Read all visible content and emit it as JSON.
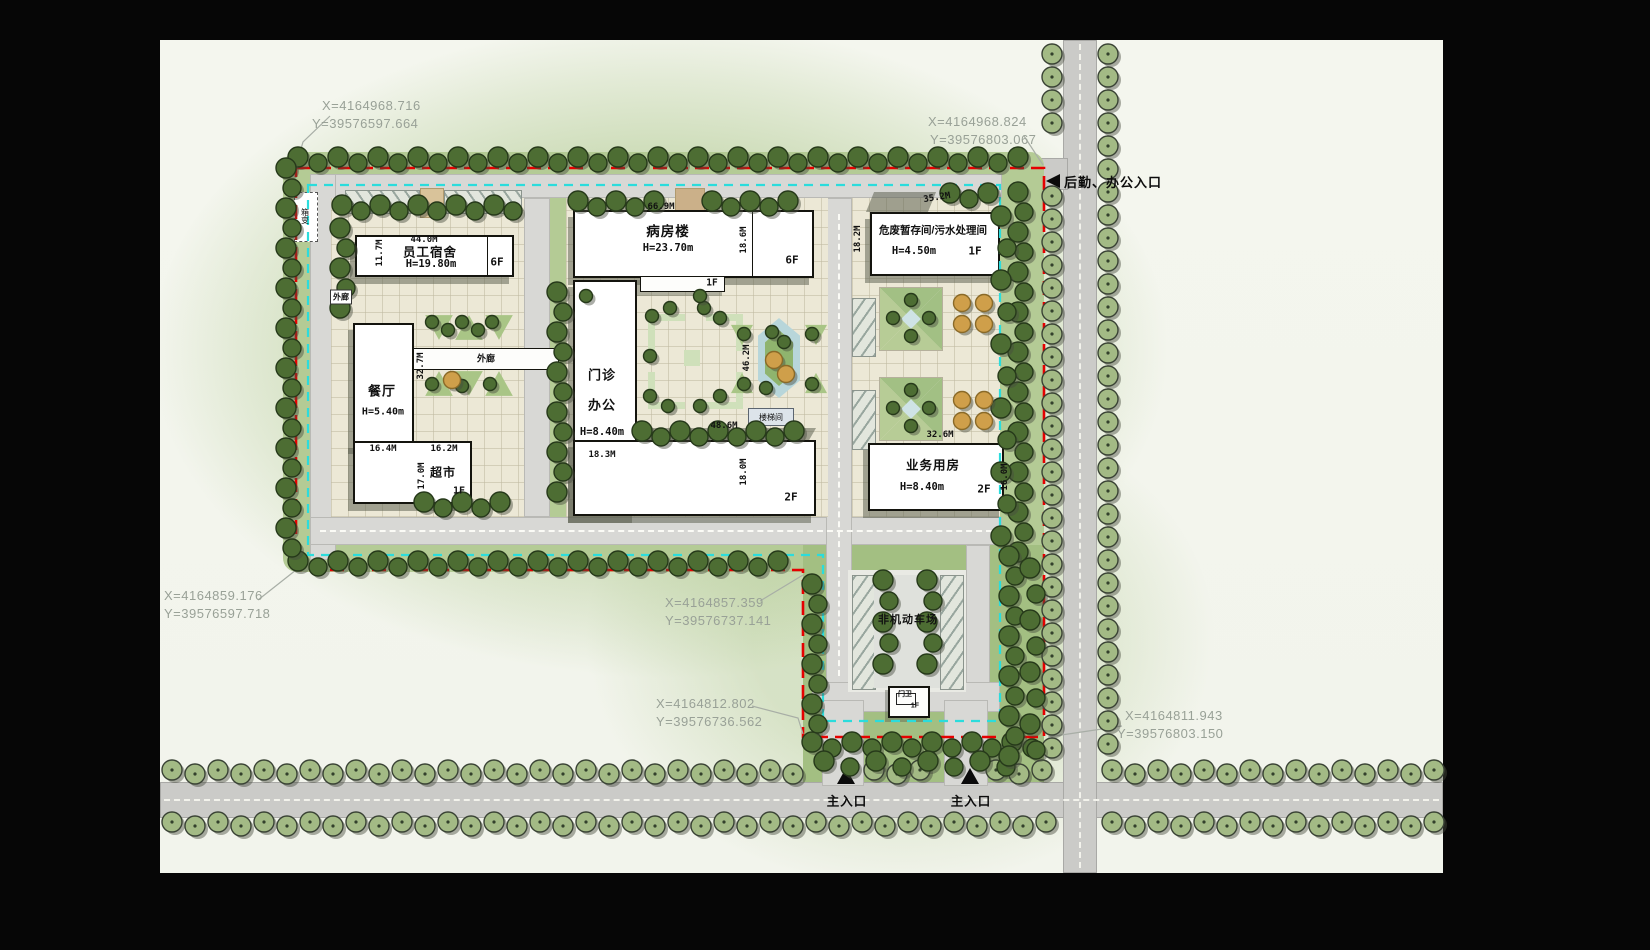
{
  "colors": {
    "boundary_red": "#e60000",
    "setback_cyan": "#2bdcdc",
    "road_gray": "#cbcbc8",
    "paving": "#ece8d6",
    "street_tree": "#a3ba85",
    "dark_tree": "#4d6d33",
    "orange_tree": "#cf9f4a"
  },
  "coordinates": {
    "top_left": {
      "x": "X=4164968.716",
      "y": "Y=39576597.664"
    },
    "top_right": {
      "x": "X=4164968.824",
      "y": "Y=39576803.067"
    },
    "left_bottom": {
      "x": "X=4164859.176",
      "y": "Y=39576597.718"
    },
    "mid_bottom": {
      "x": "X=4164857.359",
      "y": "Y=39576737.141"
    },
    "lower_left": {
      "x": "X=4164812.802",
      "y": "Y=39576736.562"
    },
    "lower_right": {
      "x": "X=4164811.943",
      "y": "Y=39576803.150"
    }
  },
  "entrances": {
    "rear": "后勤、办公入口",
    "main_left": "主入口",
    "main_right": "主入口"
  },
  "labels": {
    "parking": "非机动车场",
    "stairwell": "楼梯间",
    "corridor_main": "外廊",
    "corridor_side": "外廊",
    "transformer": "箱变",
    "gatehouse": "门卫",
    "gatehouse_floors": "1F"
  },
  "buildings": {
    "dormitory": {
      "name": "员工宿舍",
      "height": "H=19.80m",
      "floors": "6F",
      "width": "44.0M",
      "depth": "11.7M"
    },
    "ward": {
      "name": "病房楼",
      "height": "H=23.70m",
      "floors": "6F",
      "width": "66.9M",
      "depth": "18.6M",
      "canopy_floors": "1F"
    },
    "clinic": {
      "name_line1": "门诊",
      "name_line2": "办公",
      "height": "H=8.40m",
      "depth": "18.3M",
      "court_width": "48.6M",
      "court_depth": "46.2M",
      "wing_depth": "18.0M",
      "wing_floors": "2F"
    },
    "canteen": {
      "name": "餐厅",
      "height": "H=5.40m",
      "width": "16.4M",
      "side": "32.7M"
    },
    "supermarket": {
      "name": "超市",
      "floors": "1F",
      "width": "16.2M",
      "depth": "17.0M"
    },
    "hazard": {
      "name": "危废暂存间/污水处理间",
      "height": "H=4.50m",
      "floors": "1F",
      "width": "35.2M",
      "depth": "18.2M"
    },
    "business": {
      "name": "业务用房",
      "height": "H=8.40m",
      "floors": "2F",
      "width": "32.6M",
      "depth": "16.0M"
    }
  }
}
